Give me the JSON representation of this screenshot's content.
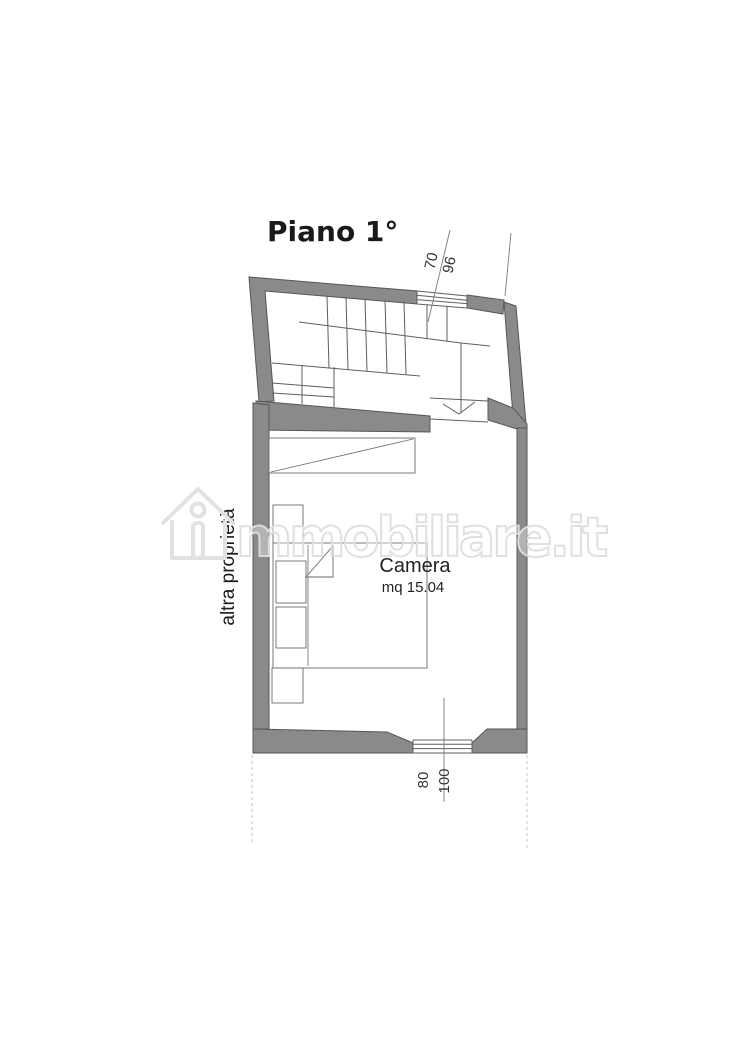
{
  "page": {
    "title": "Piano 1°"
  },
  "floorplan": {
    "room": {
      "name": "Camera",
      "area": "mq 15.04"
    },
    "adjacent_label": "altra proprietà",
    "dimensions": {
      "top_window_inner": "70",
      "top_window_outer": "96",
      "bottom_window_inner": "80",
      "bottom_window_outer": "100"
    },
    "icons": {
      "stair_direction": "chevron-down-icon"
    }
  },
  "watermark": {
    "brand": "immobiliare.it",
    "visible_text": "mmobiliare.it",
    "icon": "house-outline-icon"
  },
  "colors": {
    "wall_fill": "#8a8a8a",
    "wall_stroke": "#565656",
    "line": "#5f5f5f",
    "dashed_line": "#c4c4c4",
    "watermark": "#dedede",
    "text": "#1a1a1a"
  }
}
